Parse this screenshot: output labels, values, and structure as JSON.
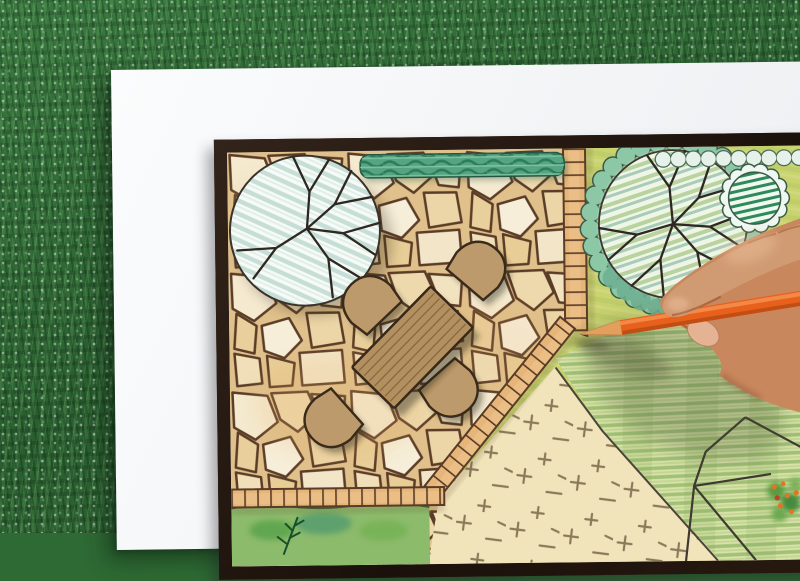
{
  "scene": {
    "description": "Overhead photo of a hand holding an orange colored pencil while drawing a garden landscape architecture plan on a white sheet of paper lying on green grass",
    "grass": {
      "label": "grass lawn background",
      "base_color": "#2e6a34"
    },
    "paper": {
      "label": "white drawing paper",
      "color": "#f4f5f7"
    },
    "frame": {
      "label": "dark plan border frame",
      "color": "#241810"
    },
    "plan": {
      "patio": {
        "label": "flagstone patio",
        "stone_color": "#f2e3c0",
        "joint_color": "#5b3c27"
      },
      "paver_border": {
        "label": "tile paver edge strips",
        "color": "#eabe85"
      },
      "hedge": {
        "label": "clipped hedge strip",
        "color": "#57a483"
      },
      "tree_left": {
        "label": "large shade tree symbol with branch spokes",
        "hatch_color": "#c6ded6"
      },
      "tree_right": {
        "label": "tree symbol ringed by scalloped shrubs",
        "ring_color": "#8cc7a6"
      },
      "corner_bush": {
        "label": "evergreen shrub with dark hatch",
        "hatch_color": "#2e8a58"
      },
      "meadow": {
        "label": "yellow-green planted area",
        "color": "#c9d46f"
      },
      "lawn": {
        "label": "striped lawn panel",
        "color": "#d7e3a9"
      },
      "groundcover": {
        "label": "groundcover bed with cross marks",
        "color": "#f1e4ba",
        "mark_color": "#8b7a5a"
      },
      "flower_bed": {
        "label": "watercolor planting bed with conifer sprig",
        "color": "#8cbb6b"
      },
      "planting_lines": {
        "label": "bed outline polylines",
        "color": "#3f3a31"
      },
      "plant_cluster": {
        "label": "shrub cluster with orange berries",
        "berry_color": "#e2761f"
      },
      "table": {
        "label": "rectangular plank table",
        "color": "#b3905f"
      },
      "chairs": {
        "label": "patio chairs",
        "count": 4,
        "color": "#bd9a6b"
      }
    },
    "hand": {
      "label": "hand gripping the pencil",
      "skin_color": "#c9875d",
      "finger_color": "#d09a72",
      "nail_color": "#e7b696"
    },
    "pencil": {
      "label": "orange colored pencil",
      "body_color": "#e8611c",
      "wood_color": "#e2a05c",
      "lead_color": "#4f3a26"
    }
  }
}
